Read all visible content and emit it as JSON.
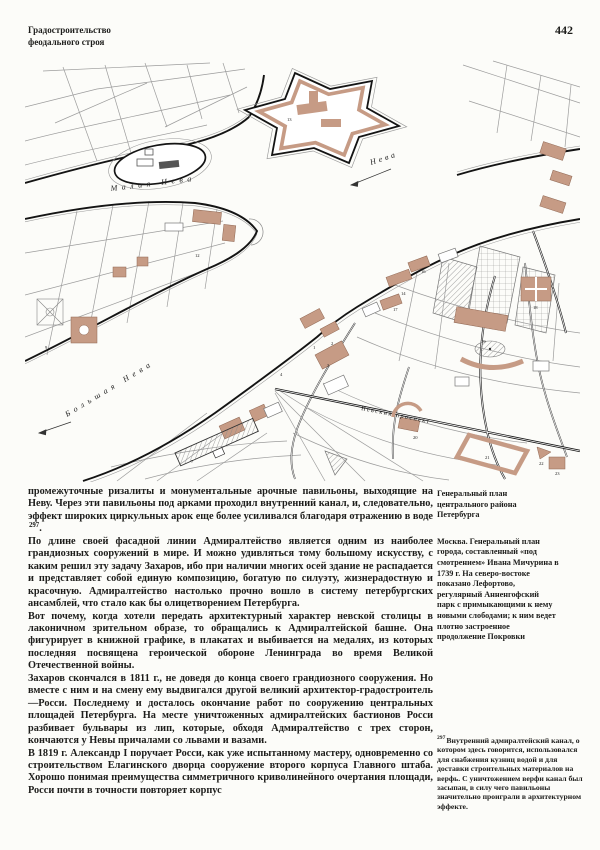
{
  "page": {
    "header_line1": "Градостроительство",
    "header_line2": "феодального строя",
    "page_number": "442"
  },
  "map": {
    "river_labels": {
      "malaya_neva": "Малая Нева",
      "neva": "Нева",
      "bolshaya_neva": "Большая Нева",
      "nevsky": "Невский проспект"
    },
    "numbers": [
      "1",
      "2",
      "3",
      "4",
      "7",
      "9",
      "12",
      "13",
      "14",
      "16",
      "17",
      "18",
      "19",
      "20",
      "21",
      "22",
      "23"
    ],
    "colors": {
      "building_tan": "#c69b85",
      "ink": "#1d1d1b"
    }
  },
  "body": {
    "p1_text": "промежуточные ризалиты и монументальные арочные павильоны, выходящие на Неву. Через эти павильоны под арками проходил внутренний канал, и, следовательно, эффект широких циркульных арок еще более усиливался благодаря отражению в воде",
    "p1_ref": "297",
    "p1_tail": ".",
    "p2": "По длине своей фасадной линии Адмиралтейство является одним из наиболее грандиозных сооружений в мире. И можно удивляться тому большому искусству, с каким решил эту задачу Захаров, ибо при наличии многих осей здание не распадается и представляет собой единую композицию, богатую по силуэту, жизнерадостную и красочную. Адмиралтейство настолько прочно вошло в систему петербургских ансамблей, что стало как бы олицетворением Петербурга.",
    "p3": "Вот почему, когда хотели передать архитектурный характер невской столицы в лаконичном зрительном образе, то обращались к Адмиралтейской башне. Она фигурирует в книжной графике, в плакатах и выбивается на медалях, из которых последняя посвящена героической обороне Ленинграда во время Великой Отечественной войны.",
    "p4": "Захаров скончался в 1811 г., не доведя до конца своего грандиозного сооружения. Но вместе с ним и на смену ему выдвигался другой великий архитектор-градостроитель—Росси. Последнему и досталось окончание работ по сооружению центральных площадей Петербурга. На месте уничтоженных адмиралтейских бастионов Росси разбивает бульвары из лип, которые, обходя Адмиралтейство с трех сторон, кончаются у Невы причалами со львами и вазами.",
    "p5": "В 1819 г. Александр I поручает Росси, как уже испытанному мастеру, одновременно со строительством Елагинского дворца сооружение второго корпуса Главного штаба. Хорошо понимая преимущества симметричного криволинейного очертания площади, Росси почти в точности повторяет корпус"
  },
  "caption": {
    "title": "Генеральный план центрального района Петербурга",
    "note": "Москва. Генеральный план города, составленный «под смотрением» Ивана Мичурина в 1739 г. На северо-востоке показано Лефортово, регулярный Анненгофский парк с примыкающими к нему новыми слободами; к ним ведет плотно застроенное продолжение Покровки"
  },
  "footnote": {
    "marker": "297",
    "text": "Внутренний адмиралтейский канал, о котором здесь говорится, использовался для снабжения кузниц водой и для доставки строительных материалов на верфь. С уничтожением верфи канал был засыпан, в силу чего павильоны значительно проиграли в архитектурном эффекте."
  }
}
